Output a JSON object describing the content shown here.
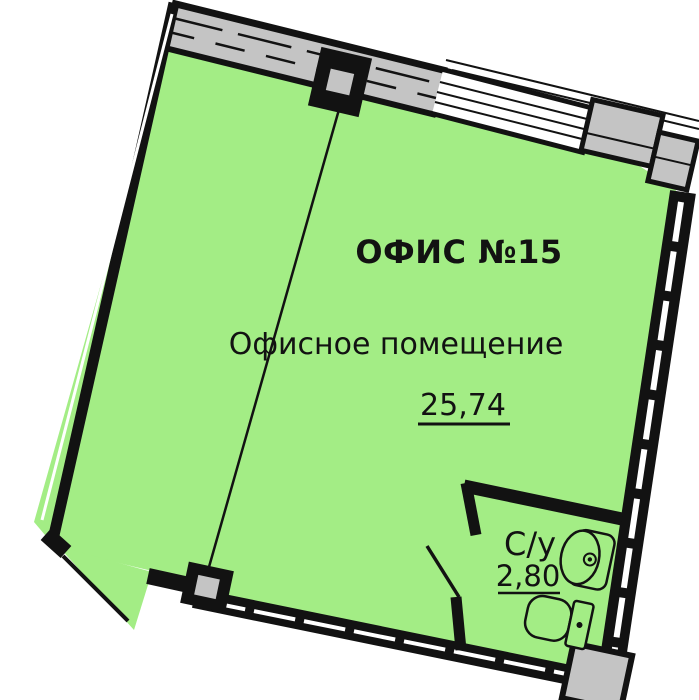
{
  "plan": {
    "title": "ОФИС №15",
    "rooms": [
      {
        "name": "Офисное помещение",
        "area": "25,74"
      },
      {
        "name": "С/у",
        "area": "2,80"
      }
    ]
  },
  "icons": [
    "sink-icon",
    "toilet-icon",
    "window-glazing",
    "door-leaf"
  ],
  "colors": {
    "room-fill": "#A3ED85",
    "wall-gray": "#C4C4C4",
    "ink": "#121212",
    "paper": "#FFFFFF"
  }
}
